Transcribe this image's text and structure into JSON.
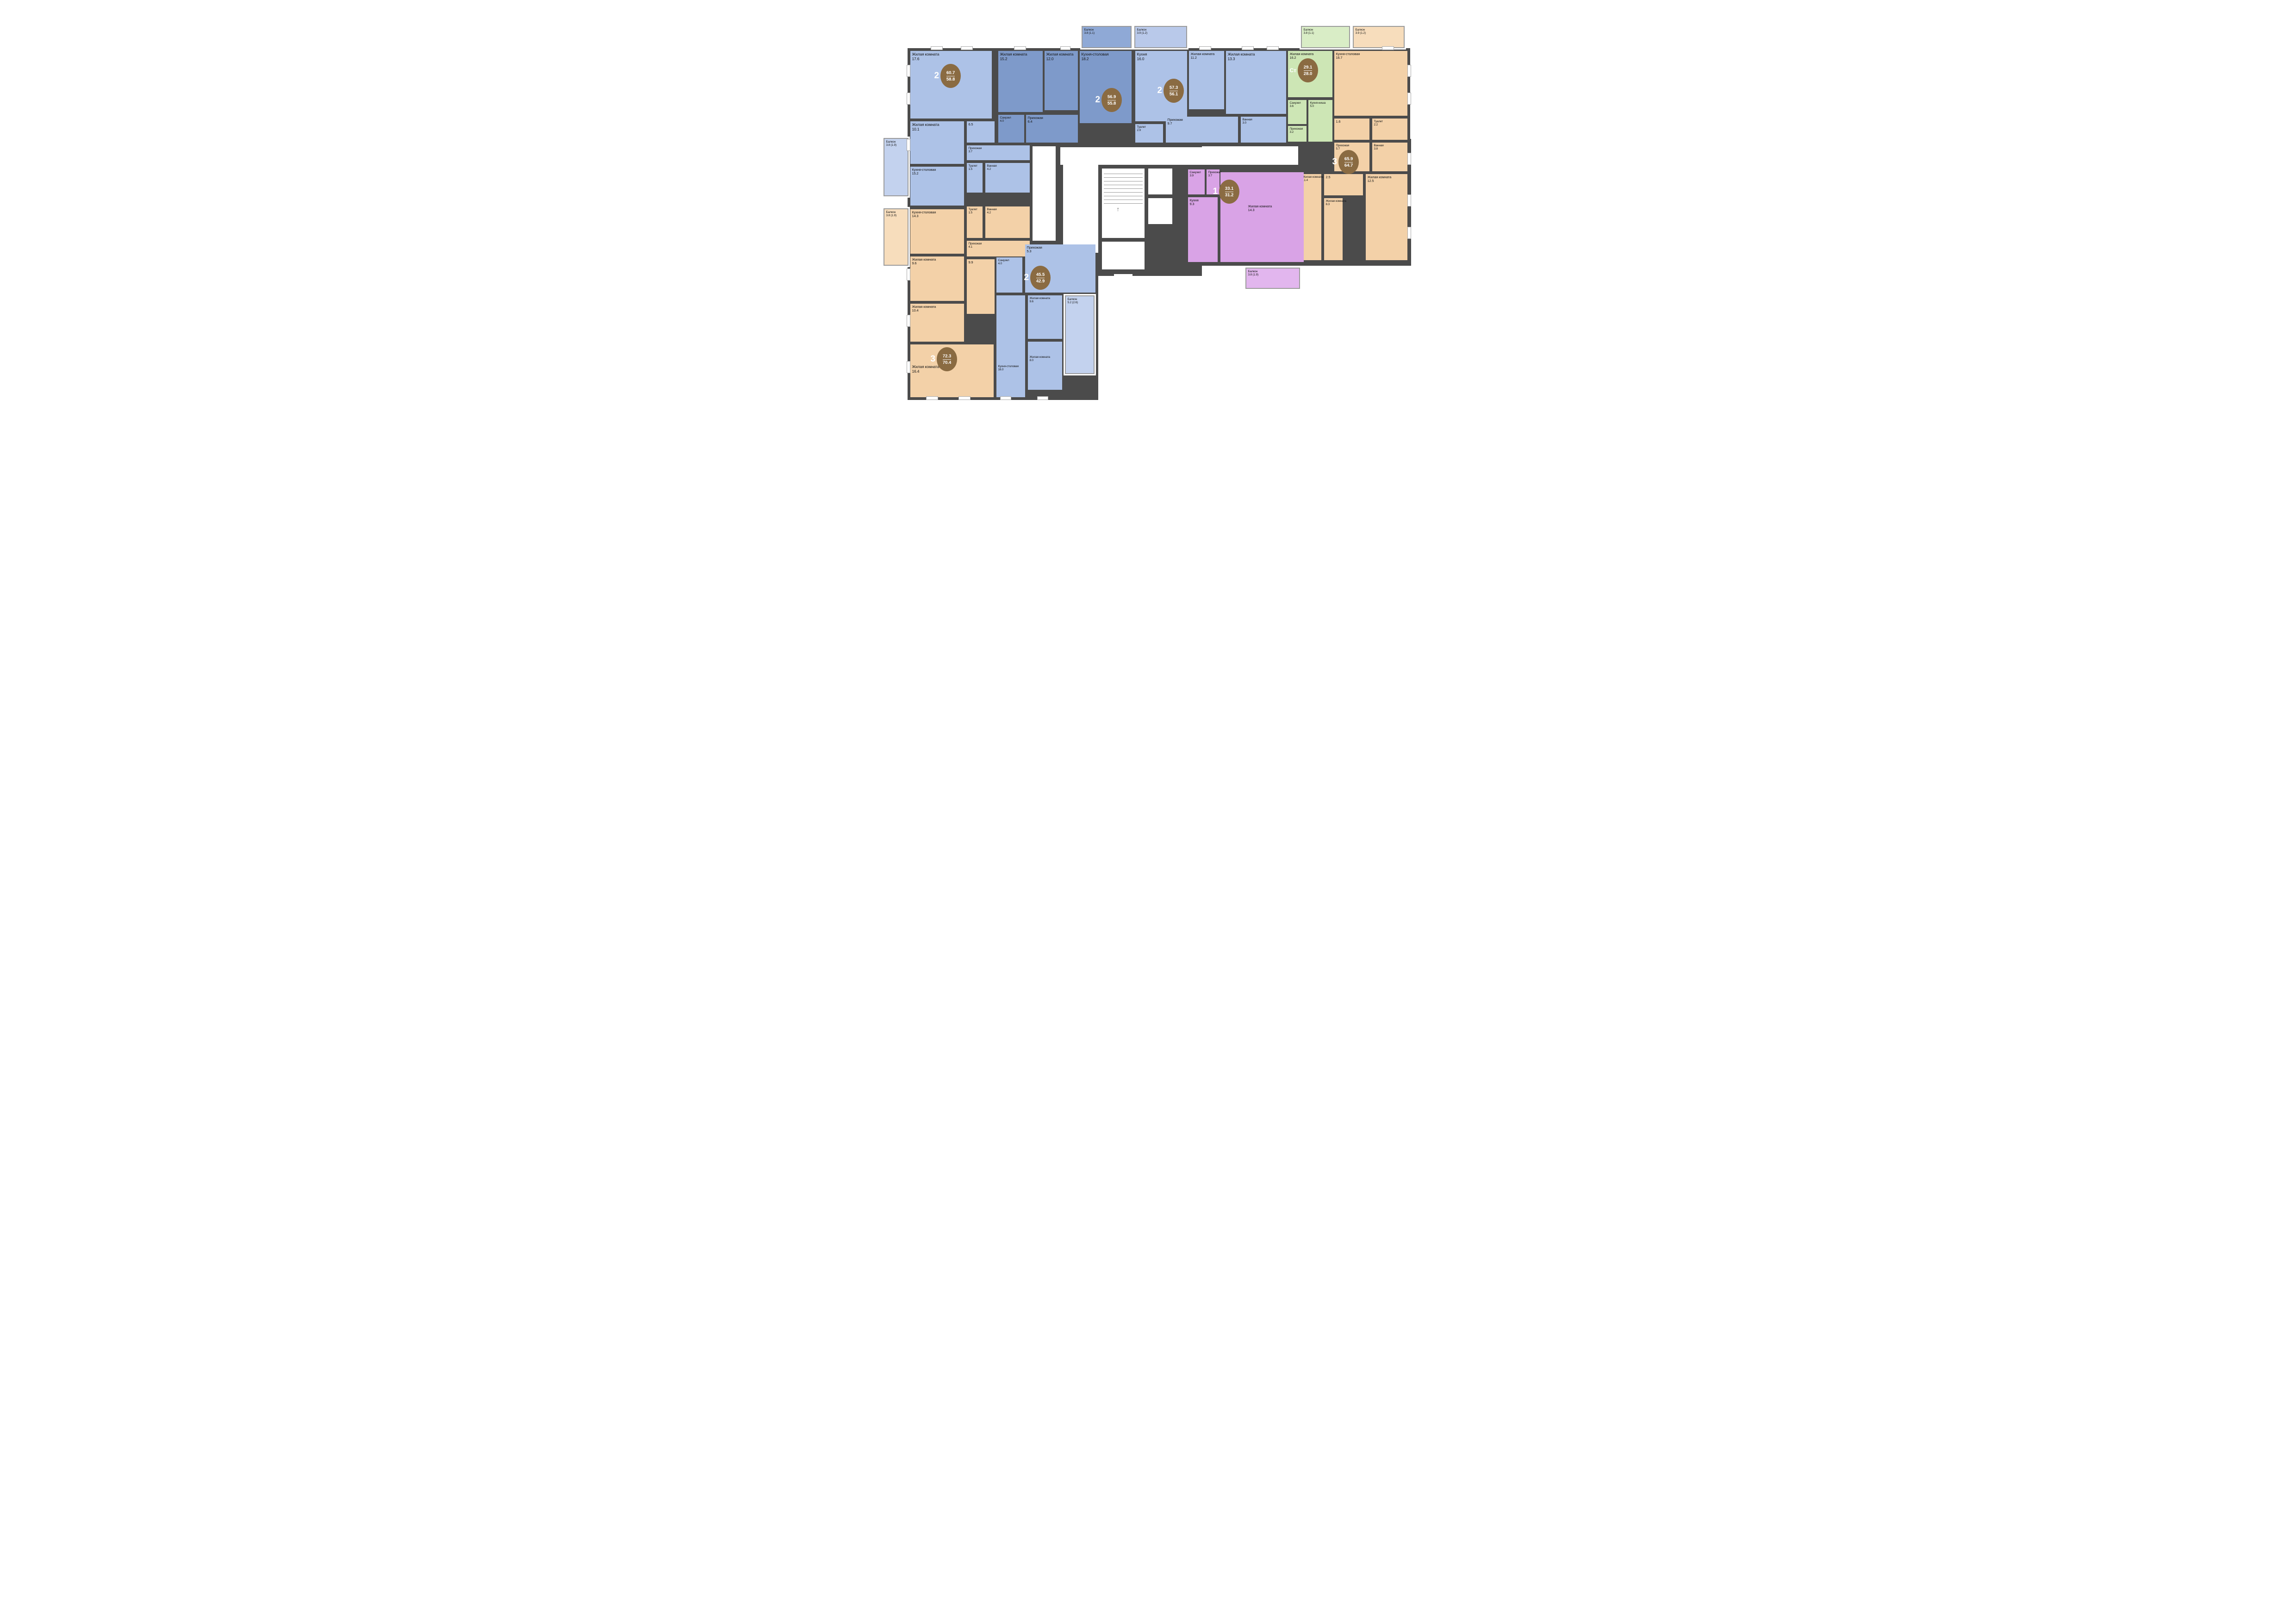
{
  "palette": {
    "wall_color": "#4b4b4b",
    "badge_color": "#8a6b42",
    "one_room_color": "#d9a3e6",
    "two_room_light_color": "#adc2e7",
    "two_room_dark_color": "#7e9aca",
    "three_room_color": "#f3d1a8",
    "studio_color": "#cde6b5"
  },
  "apartments": [
    {
      "id": "apt-2-607",
      "rooms_count": "2",
      "area_total": "60.7",
      "area_living": "58.8",
      "color": "#adc2e7",
      "balcony_color": "#c3d2ee",
      "rooms": [
        {
          "name": "Жилая комната",
          "area": "17.6"
        },
        {
          "name": "Жилая комната",
          "area": "10.1"
        },
        {
          "name": "",
          "area": "6.5"
        },
        {
          "name": "Прихожая",
          "area": "3.7"
        },
        {
          "name": "Кухня-столовая",
          "area": "15.2"
        },
        {
          "name": "Туалет",
          "area": "1.5"
        },
        {
          "name": "Ванная",
          "area": "4.2"
        },
        {
          "name": "Балкон",
          "area": "3.8 (1.9)"
        }
      ]
    },
    {
      "id": "apt-2-569",
      "rooms_count": "2",
      "area_total": "56.9",
      "area_living": "55.8",
      "color": "#7e9aca",
      "balcony_color": "#8fa9d6",
      "rooms": [
        {
          "name": "Жилая комната",
          "area": "15.2"
        },
        {
          "name": "Жилая комната",
          "area": "12.0"
        },
        {
          "name": "Кухня-столовая",
          "area": "18.2"
        },
        {
          "name": "Санузел",
          "area": "4.0"
        },
        {
          "name": "Прихожая",
          "area": "6.4"
        },
        {
          "name": "Балкон",
          "area": "3.8 (1.1)"
        }
      ]
    },
    {
      "id": "apt-2-573",
      "rooms_count": "2",
      "area_total": "57.3",
      "area_living": "56.1",
      "color": "#adc2e7",
      "balcony_color": "#b9c9ea",
      "rooms": [
        {
          "name": "Кухня",
          "area": "16.0"
        },
        {
          "name": "Жилая комната",
          "area": "11.2"
        },
        {
          "name": "Жилая комната",
          "area": "13.3"
        },
        {
          "name": "Туалет",
          "area": "2.9"
        },
        {
          "name": "Прихожая",
          "area": "9.7"
        },
        {
          "name": "Ванная",
          "area": "3.0"
        },
        {
          "name": "Балкон",
          "area": "3.9 (1.2)"
        }
      ]
    },
    {
      "id": "apt-st-291",
      "rooms_count": "Ст",
      "area_total": "29.1",
      "area_living": "28.0",
      "color": "#cde6b5",
      "balcony_color": "#d9edc6",
      "rooms": [
        {
          "name": "Жилая комната",
          "area": "16.2"
        },
        {
          "name": "Кухня-ниша",
          "area": "5.0"
        },
        {
          "name": "Санузел",
          "area": "3.6"
        },
        {
          "name": "Прихожая",
          "area": "3.2"
        },
        {
          "name": "Балкон",
          "area": "3.8 (1.1)"
        }
      ]
    },
    {
      "id": "apt-3-659",
      "rooms_count": "3",
      "area_total": "65.9",
      "area_living": "64.7",
      "color": "#f3d1a8",
      "balcony_color": "#f7ddbc",
      "rooms": [
        {
          "name": "Кухня-столовая",
          "area": "16.7"
        },
        {
          "name": "",
          "area": "1.6"
        },
        {
          "name": "Туалет",
          "area": "2.2"
        },
        {
          "name": "Прихожая",
          "area": "5.7"
        },
        {
          "name": "Ванная",
          "area": "3.8"
        },
        {
          "name": "",
          "area": "2.5"
        },
        {
          "name": "Жилая комната",
          "area": "11.4"
        },
        {
          "name": "Жилая комната",
          "area": "8.3"
        },
        {
          "name": "Жилая комната",
          "area": "12.5"
        },
        {
          "name": "Балкон",
          "area": "3.9 (1.2)"
        }
      ]
    },
    {
      "id": "apt-1-331",
      "rooms_count": "1",
      "area_total": "33.1",
      "area_living": "31.2",
      "color": "#d9a3e6",
      "balcony_color": "#e2b6ee",
      "rooms": [
        {
          "name": "Санузел",
          "area": "3.9"
        },
        {
          "name": "Прихожая",
          "area": "3.7"
        },
        {
          "name": "Кухня",
          "area": "9.3"
        },
        {
          "name": "Жилая комната",
          "area": "14.3"
        },
        {
          "name": "Балкон",
          "area": "3.8 (1.9)"
        }
      ]
    },
    {
      "id": "apt-3-723",
      "rooms_count": "3",
      "area_total": "72.3",
      "area_living": "70.4",
      "color": "#f3d1a8",
      "balcony_color": "#f7ddbc",
      "rooms": [
        {
          "name": "Балкон",
          "area": "3.8 (1.9)"
        },
        {
          "name": "Кухня-столовая",
          "area": "14.3"
        },
        {
          "name": "Туалет",
          "area": "1.5"
        },
        {
          "name": "Ванная",
          "area": "4.2"
        },
        {
          "name": "Прихожая",
          "area": "4.1"
        },
        {
          "name": "Жилая комната",
          "area": "9.6"
        },
        {
          "name": "",
          "area": "9.9"
        },
        {
          "name": "Жилая комната",
          "area": "10.4"
        },
        {
          "name": "Жилая комната",
          "area": "16.4"
        }
      ]
    },
    {
      "id": "apt-2-455",
      "rooms_count": "2",
      "area_total": "45.5",
      "area_living": "42.9",
      "color": "#adc2e7",
      "balcony_color": "#c3d2ee",
      "rooms": [
        {
          "name": "Санузел",
          "area": "4.0"
        },
        {
          "name": "Прихожая",
          "area": "5.3"
        },
        {
          "name": "Жилая комната",
          "area": "9.6"
        },
        {
          "name": "Кухня-столовая",
          "area": "16.0"
        },
        {
          "name": "Жилая комната",
          "area": "8.0"
        },
        {
          "name": "Балкон",
          "area": "5.2 (2.6)"
        }
      ]
    }
  ]
}
